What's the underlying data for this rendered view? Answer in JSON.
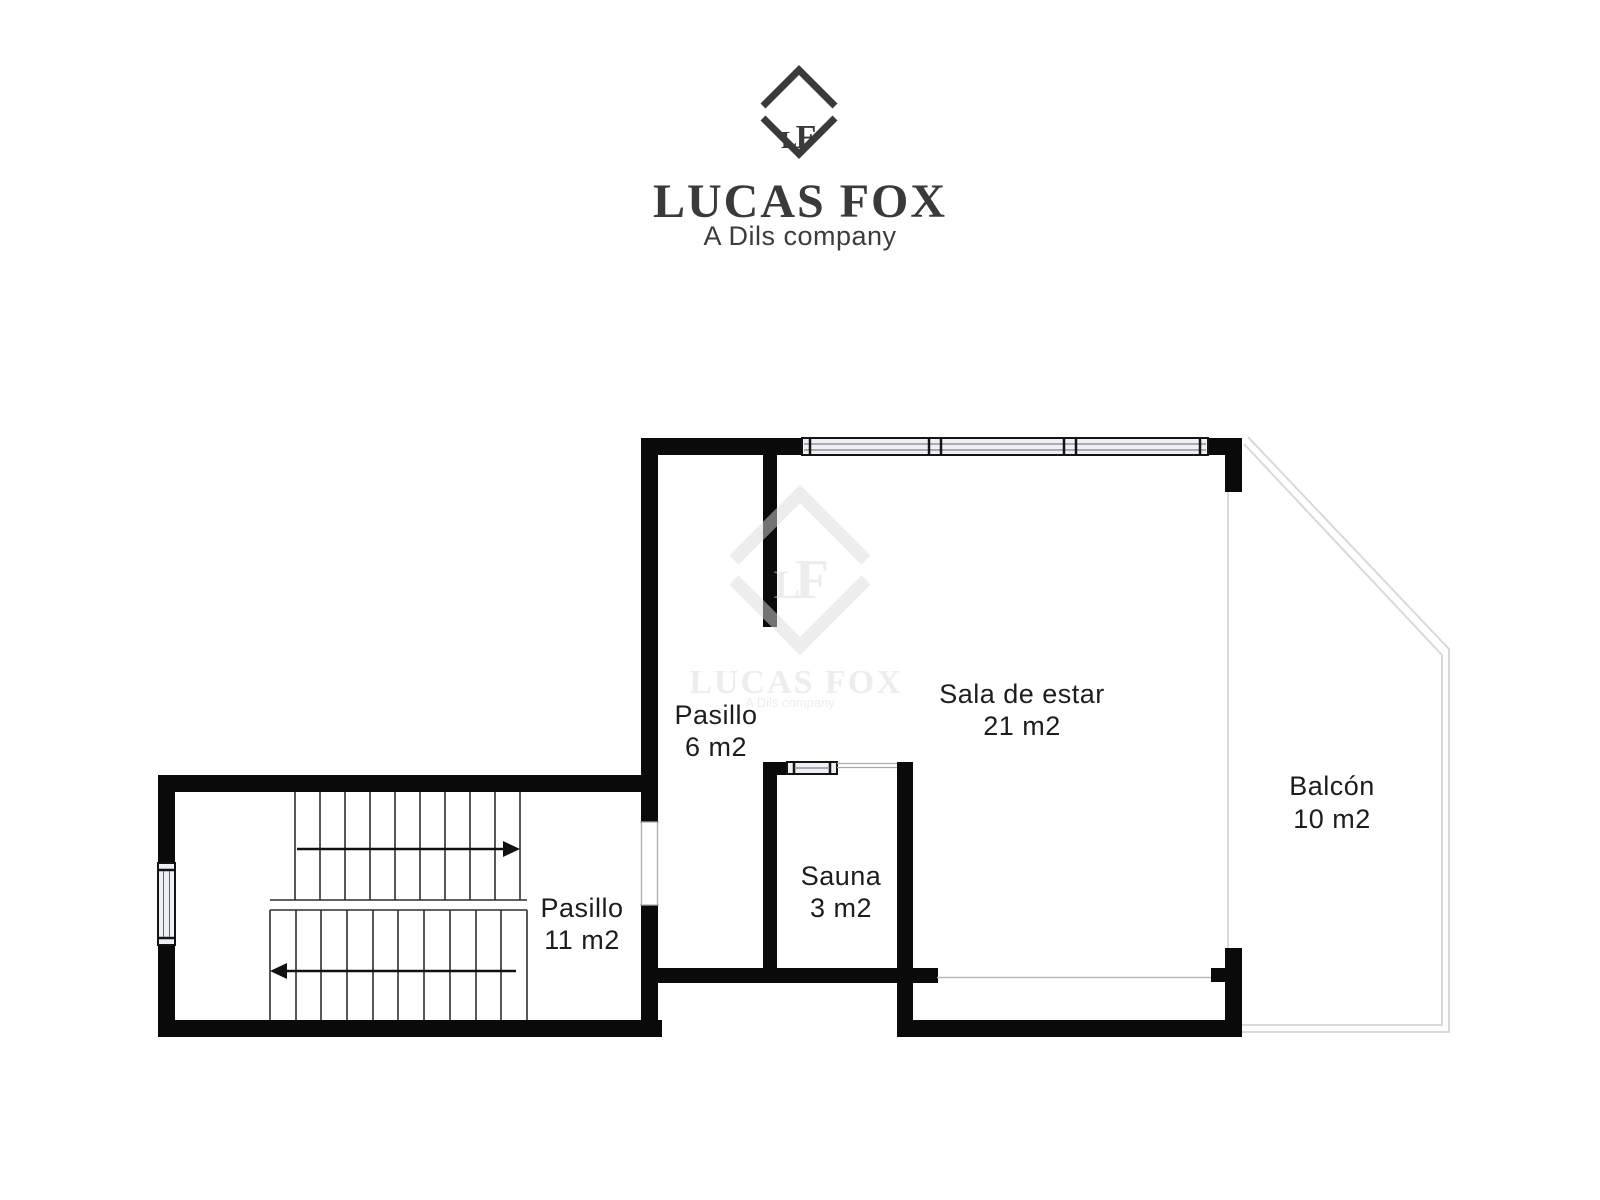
{
  "branding": {
    "monogram_l": "L",
    "monogram_f": "F",
    "company": "LUCAS FOX",
    "tagline": "A Dils company"
  },
  "watermark": {
    "monogram_l": "L",
    "monogram_f": "F",
    "company": "LUCAS FOX",
    "tagline": "A Dils company"
  },
  "rooms": [
    {
      "name": "Pasillo",
      "area": "6 m2"
    },
    {
      "name": "Sala de estar",
      "area": "21 m2"
    },
    {
      "name": "Balcón",
      "area": "10 m2"
    },
    {
      "name": "Sauna",
      "area": "3 m2"
    },
    {
      "name": "Pasillo",
      "area": "11 m2"
    }
  ],
  "colors": {
    "wall": "#0a0a0a",
    "brand_text": "#3a3a3c",
    "room_label": "#1d1d1d",
    "balcony_outline": "#d9d9d9",
    "window_fill": "#eef0f6",
    "watermark": "#dcdcdc"
  }
}
